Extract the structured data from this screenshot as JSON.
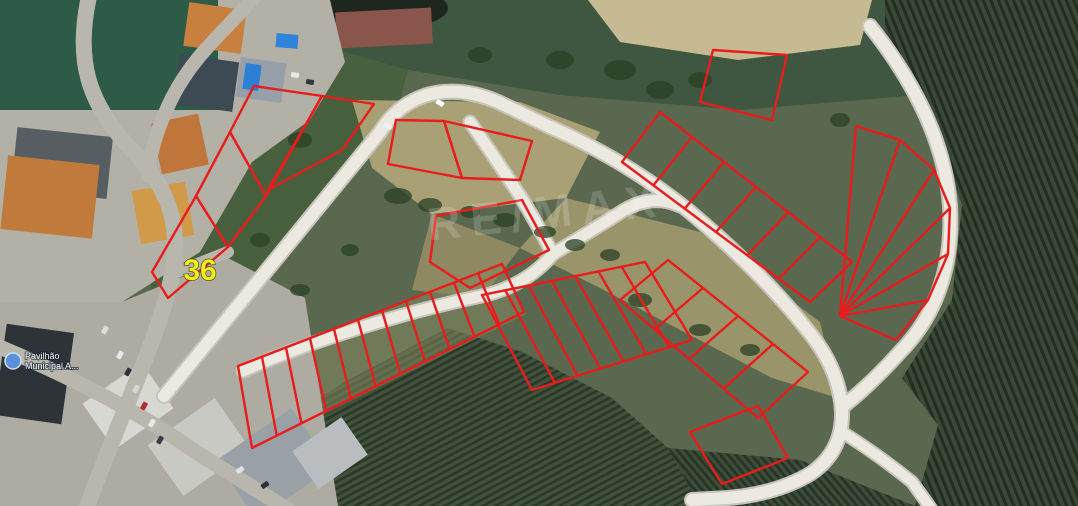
{
  "meta": {
    "title": "Aerial land-lot plan photo",
    "width": 1078,
    "height": 506
  },
  "labels": {
    "plot_number": "36",
    "watermark": "RE/MAX",
    "place_line1": "Pavilhão",
    "place_line2": "Municipal A..."
  },
  "colors": {
    "plot_outline": "#e81c1c",
    "plot_label": "#f2ee1a",
    "plot_label_stroke": "#3a3a00",
    "watermark": "rgba(255,255,255,0.17)",
    "road_fill": "#ece9e1",
    "road_casing": "#c7c4ba",
    "urban_street": "#b8b6ad",
    "tree": "#2a4026",
    "place_icon": "#5b8fd8",
    "place_text": "#eef2fa"
  },
  "map": {
    "patterns": [
      {
        "id": "vineR",
        "base": "#3a4a36",
        "stripe": "#232e21",
        "gap": 7,
        "angle": -22
      },
      {
        "id": "vineB",
        "base": "#41523c",
        "stripe": "#2b3828",
        "gap": 6,
        "angle": 62
      },
      {
        "id": "vineB2",
        "base": "#3c4d38",
        "stripe": "#273325",
        "gap": 6,
        "angle": -40
      }
    ],
    "terrain": [
      {
        "name": "base-ground",
        "type": "rect",
        "x": 0,
        "y": 0,
        "w": 1078,
        "h": 506,
        "fill": "#5a6850"
      },
      {
        "name": "scrub-top",
        "type": "polygon",
        "pts": "320,0 1078,0 1078,70 920,95 740,110 560,95 408,70 330,48",
        "fill": "#3f5640"
      },
      {
        "name": "green-mid-left",
        "type": "polygon",
        "pts": "210,55 330,48 408,70 395,120 175,385 150,300 158,170",
        "fill": "#49603f"
      },
      {
        "name": "vineyard-right",
        "type": "polygon",
        "pts": "885,0 1078,0 1078,506 915,506 938,425 902,378 952,300 962,205 918,85 885,40",
        "fill": "pattern:vineR"
      },
      {
        "name": "vineyard-bottom",
        "type": "polygon",
        "pts": "250,440 352,378 448,328 522,352 612,398 668,448 700,506 250,506",
        "fill": "pattern:vineB"
      },
      {
        "name": "vineyard-bottom-right",
        "type": "polygon",
        "pts": "668,448 800,460 915,506 700,506",
        "fill": "pattern:vineB2"
      },
      {
        "name": "cleared-upper",
        "type": "polygon",
        "pts": "352,100 520,102 600,132 566,198 432,214 372,168",
        "fill": "#b0a678",
        "opacity": 0.92
      },
      {
        "name": "cleared-right",
        "type": "polygon",
        "pts": "566,198 700,232 820,322 838,398 772,378 600,288 520,248",
        "fill": "#a69c6e",
        "opacity": 0.85
      },
      {
        "name": "cleared-triangle",
        "type": "polygon",
        "pts": "432,214 520,248 482,298 412,290",
        "fill": "#9b9168",
        "opacity": 0.8
      },
      {
        "name": "cleared-comb-band",
        "type": "polygon",
        "pts": "235,368 502,263 526,314 252,450",
        "fill": "#84875e",
        "opacity": 0.55
      },
      {
        "name": "sand-mound",
        "type": "polygon",
        "pts": "588,0 872,0 860,45 738,60 620,42",
        "fill": "#c6ba92"
      },
      {
        "name": "pond",
        "type": "ellipse",
        "cx": 350,
        "cy": 8,
        "rx": 98,
        "ry": 26,
        "fill": "#1d271f"
      },
      {
        "name": "roof-top-center",
        "type": "rect",
        "x": 336,
        "y": 10,
        "w": 96,
        "h": 36,
        "rot": -3,
        "fill": "#8a564c"
      },
      {
        "name": "sports-field",
        "type": "rect",
        "x": 0,
        "y": 0,
        "w": 218,
        "h": 110,
        "fill": "#2d5b47"
      },
      {
        "name": "urban-top-left",
        "type": "polygon",
        "pts": "0,110 218,110 218,0 330,0 345,62 310,120 252,162 200,252 122,302 0,302",
        "fill": "#b3b0a6"
      },
      {
        "name": "urban-bottom-left",
        "type": "polygon",
        "pts": "0,302 122,302 228,258 305,298 338,506 0,506",
        "fill": "#aeaca2"
      }
    ],
    "buildings": [
      {
        "x": 186,
        "y": 6,
        "w": 58,
        "h": 44,
        "rot": 8,
        "fill": "#c8803e"
      },
      {
        "x": 176,
        "y": 58,
        "w": 60,
        "h": 50,
        "rot": 8,
        "fill": "#3d4a54"
      },
      {
        "x": 238,
        "y": 60,
        "w": 46,
        "h": 40,
        "rot": 8,
        "fill": "#97a0a8"
      },
      {
        "x": 244,
        "y": 64,
        "w": 16,
        "h": 26,
        "rot": 8,
        "fill": "#2d7fd4"
      },
      {
        "x": 276,
        "y": 34,
        "w": 22,
        "h": 14,
        "rot": 5,
        "fill": "#2e84d8"
      },
      {
        "x": 156,
        "y": 118,
        "w": 48,
        "h": 52,
        "rot": -12,
        "fill": "#c0763a"
      },
      {
        "x": 14,
        "y": 132,
        "w": 96,
        "h": 62,
        "rot": 6,
        "fill": "#565e62"
      },
      {
        "x": 4,
        "y": 160,
        "w": 92,
        "h": 74,
        "rot": 6,
        "fill": "#c07a3c"
      },
      {
        "x": 136,
        "y": 186,
        "w": 54,
        "h": 54,
        "rot": -10,
        "fill": "#d09a48"
      },
      {
        "x": 92,
        "y": 378,
        "w": 72,
        "h": 56,
        "rot": -35,
        "fill": "#d8d8d2"
      },
      {
        "x": 158,
        "y": 416,
        "w": 82,
        "h": 62,
        "rot": -35,
        "fill": "#c9c9c3"
      },
      {
        "x": 228,
        "y": 428,
        "w": 92,
        "h": 72,
        "rot": -35,
        "fill": "#9aa1a6"
      },
      {
        "x": 300,
        "y": 430,
        "w": 60,
        "h": 46,
        "rot": -35,
        "fill": "#b9bdc0"
      },
      {
        "x": 0,
        "y": 328,
        "w": 68,
        "h": 92,
        "rot": 8,
        "fill": "#2e3338"
      }
    ],
    "urban_roads": [
      {
        "name": "street-west",
        "d": "M 90,-8 C 74,60 88,104 132,150 C 168,188 182,224 172,274 C 162,330 118,420 86,510",
        "w": 16
      },
      {
        "name": "street-top-diagonal",
        "d": "M 258,-8 C 234,24 196,50 172,98 C 160,122 150,150 148,176",
        "w": 14
      },
      {
        "name": "street-south",
        "d": "M -5,345 C 60,372 130,406 196,452 C 230,474 258,490 288,510",
        "w": 15
      },
      {
        "name": "street-link",
        "d": "M 172,274 L 228,252",
        "w": 12
      }
    ],
    "dev_roads": [
      {
        "name": "road-main-loop",
        "d": "M 164,396 L 380,132 Q 396,106 424,96 Q 458,85 498,102 L 548,126 Q 626,160 690,212 Q 766,276 812,336 Q 840,372 842,412 Q 843,452 810,474 Q 776,494 728,498 L 692,500",
        "w": 12
      },
      {
        "name": "road-middle-v",
        "d": "M 470,122 Q 498,162 524,202 Q 539,228 553,254 Q 528,284 486,295 Q 418,309 350,331 Q 290,350 243,371",
        "w": 11
      },
      {
        "name": "road-middle-v-east",
        "d": "M 553,254 Q 586,234 618,214 Q 650,192 680,206",
        "w": 11
      },
      {
        "name": "road-east-curve",
        "d": "M 870,26 Q 943,118 950,206 Q 955,296 900,352 Q 872,383 846,404",
        "w": 12
      },
      {
        "name": "road-south-spur",
        "d": "M 842,432 Q 880,456 912,482 L 932,510",
        "w": 10
      }
    ],
    "plots": [
      {
        "name": "plot-36",
        "pts": "152,272 196,196 228,247 168,298"
      },
      {
        "name": "plot-left-2",
        "pts": "196,196 230,132 266,196 228,247"
      },
      {
        "name": "plot-left-3",
        "pts": "230,132 254,86 322,96 266,196"
      },
      {
        "name": "plot-left-4",
        "pts": "322,96 374,104 342,150 268,190"
      },
      {
        "name": "plot-top-1",
        "pts": "396,120 444,121 462,178 388,164"
      },
      {
        "name": "plot-top-2",
        "pts": "444,121 532,141 520,180 462,178"
      },
      {
        "name": "plot-topright",
        "pts": "713,50 787,55 772,120 700,102"
      },
      {
        "name": "plot-triangle",
        "pts": "436,216 522,200 549,250 470,288 430,262"
      },
      {
        "name": "plot-hairpin",
        "pts": "690,432 758,406 788,458 722,484"
      }
    ],
    "combs": [
      {
        "name": "comb-southwest",
        "corners": [
          [
            238,
            366
          ],
          [
            502,
            264
          ],
          [
            524,
            312
          ],
          [
            252,
            448
          ]
        ],
        "div": 11
      },
      {
        "name": "comb-middle",
        "corners": [
          [
            482,
            295
          ],
          [
            645,
            262
          ],
          [
            692,
            340
          ],
          [
            532,
            390
          ]
        ],
        "div": 7
      },
      {
        "name": "comb-northeast",
        "corners": [
          [
            622,
            162
          ],
          [
            810,
            302
          ],
          [
            852,
            262
          ],
          [
            660,
            112
          ]
        ],
        "div": 6
      },
      {
        "name": "comb-roadside",
        "corners": [
          [
            668,
            260
          ],
          [
            808,
            372
          ],
          [
            758,
            418
          ],
          [
            620,
            300
          ]
        ],
        "div": 4
      }
    ],
    "fan": {
      "name": "crescent-fan",
      "focus": [
        840,
        316
      ],
      "arc": [
        [
          856,
          126
        ],
        [
          900,
          140
        ],
        [
          934,
          170
        ],
        [
          950,
          208
        ],
        [
          948,
          254
        ],
        [
          928,
          300
        ],
        [
          896,
          340
        ]
      ]
    },
    "trees": [
      [
        398,
        196,
        14,
        8
      ],
      [
        430,
        205,
        12,
        7
      ],
      [
        470,
        212,
        10,
        6
      ],
      [
        505,
        220,
        12,
        7
      ],
      [
        545,
        232,
        11,
        6
      ],
      [
        575,
        245,
        10,
        6
      ],
      [
        350,
        250,
        9,
        6
      ],
      [
        300,
        290,
        10,
        6
      ],
      [
        620,
        70,
        16,
        10
      ],
      [
        660,
        90,
        14,
        9
      ],
      [
        700,
        80,
        12,
        8
      ],
      [
        560,
        60,
        14,
        9
      ],
      [
        480,
        55,
        12,
        8
      ],
      [
        840,
        120,
        10,
        7
      ],
      [
        300,
        140,
        12,
        8
      ],
      [
        260,
        240,
        10,
        7
      ],
      [
        610,
        255,
        10,
        6
      ],
      [
        640,
        300,
        12,
        7
      ],
      [
        700,
        330,
        11,
        6
      ],
      [
        750,
        350,
        10,
        6
      ]
    ],
    "cars": [
      [
        120,
        355,
        -60,
        "#e8e8e8"
      ],
      [
        128,
        372,
        -60,
        "#30343a"
      ],
      [
        136,
        389,
        -60,
        "#d8d8d8"
      ],
      [
        144,
        406,
        -60,
        "#b03030"
      ],
      [
        152,
        423,
        -60,
        "#e8e8e8"
      ],
      [
        160,
        440,
        -60,
        "#3a3e44"
      ],
      [
        105,
        330,
        -60,
        "#dcdcdc"
      ],
      [
        240,
        470,
        -35,
        "#e0e0e0"
      ],
      [
        265,
        485,
        -35,
        "#2e3236"
      ],
      [
        295,
        75,
        10,
        "#e8e8e8"
      ],
      [
        310,
        82,
        10,
        "#34383e"
      ],
      [
        388,
        126,
        35,
        "#f0f0f0"
      ],
      [
        440,
        103,
        30,
        "#ffffff"
      ]
    ],
    "watermark_pos": {
      "x": 548,
      "y": 228,
      "rot": -6,
      "size": 46
    },
    "plot_label_pos": {
      "x": 200,
      "y": 280,
      "size": 30
    },
    "place_label_pos": {
      "icon_x": 13,
      "icon_y": 361,
      "r": 8,
      "x": 25,
      "y1": 359,
      "y2": 369,
      "size": 9
    }
  }
}
